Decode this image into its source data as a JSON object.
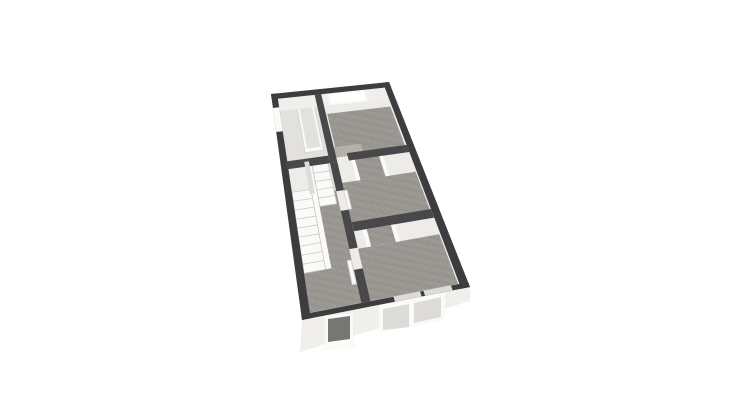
{
  "scene": {
    "type": "3d-floor-plan-render",
    "background": "#ffffff",
    "building": "house-upper-floor-birds-eye-view"
  },
  "palette": {
    "background": "#ffffff",
    "wallDark": "#3d3d3f",
    "wallInt": "#48484a",
    "wallLight": "#dddcd8",
    "facade": "#f0efec",
    "floorLight": "#edece9",
    "floorBath": "#e2e1dd",
    "carpet": "#9a9792",
    "carpetSpeckleDark": "#8f8c87",
    "carpetSpeckleLight": "#a6a39e",
    "carpetDark": "#8e8b86",
    "carpetLight": "#b4b1ab",
    "fixture": "#fafaf8",
    "glass": "#dcdbd7",
    "glassDark": "#777672",
    "treadStroke": "#c9c8c4",
    "tubRim": "#d6d5d1"
  },
  "elements": {
    "features": [
      "bathroom-with-bathtub",
      "bathroom-side-window",
      "back-bedroom-rear-window",
      "landing-closet",
      "staircase-short-flight",
      "staircase-long-flight",
      "corridor-carpet",
      "middle-bedroom-chimney-breast",
      "front-bedroom-chimney-breast",
      "open-door-leaves",
      "front-facade-double-window",
      "front-facade-small-window"
    ]
  }
}
